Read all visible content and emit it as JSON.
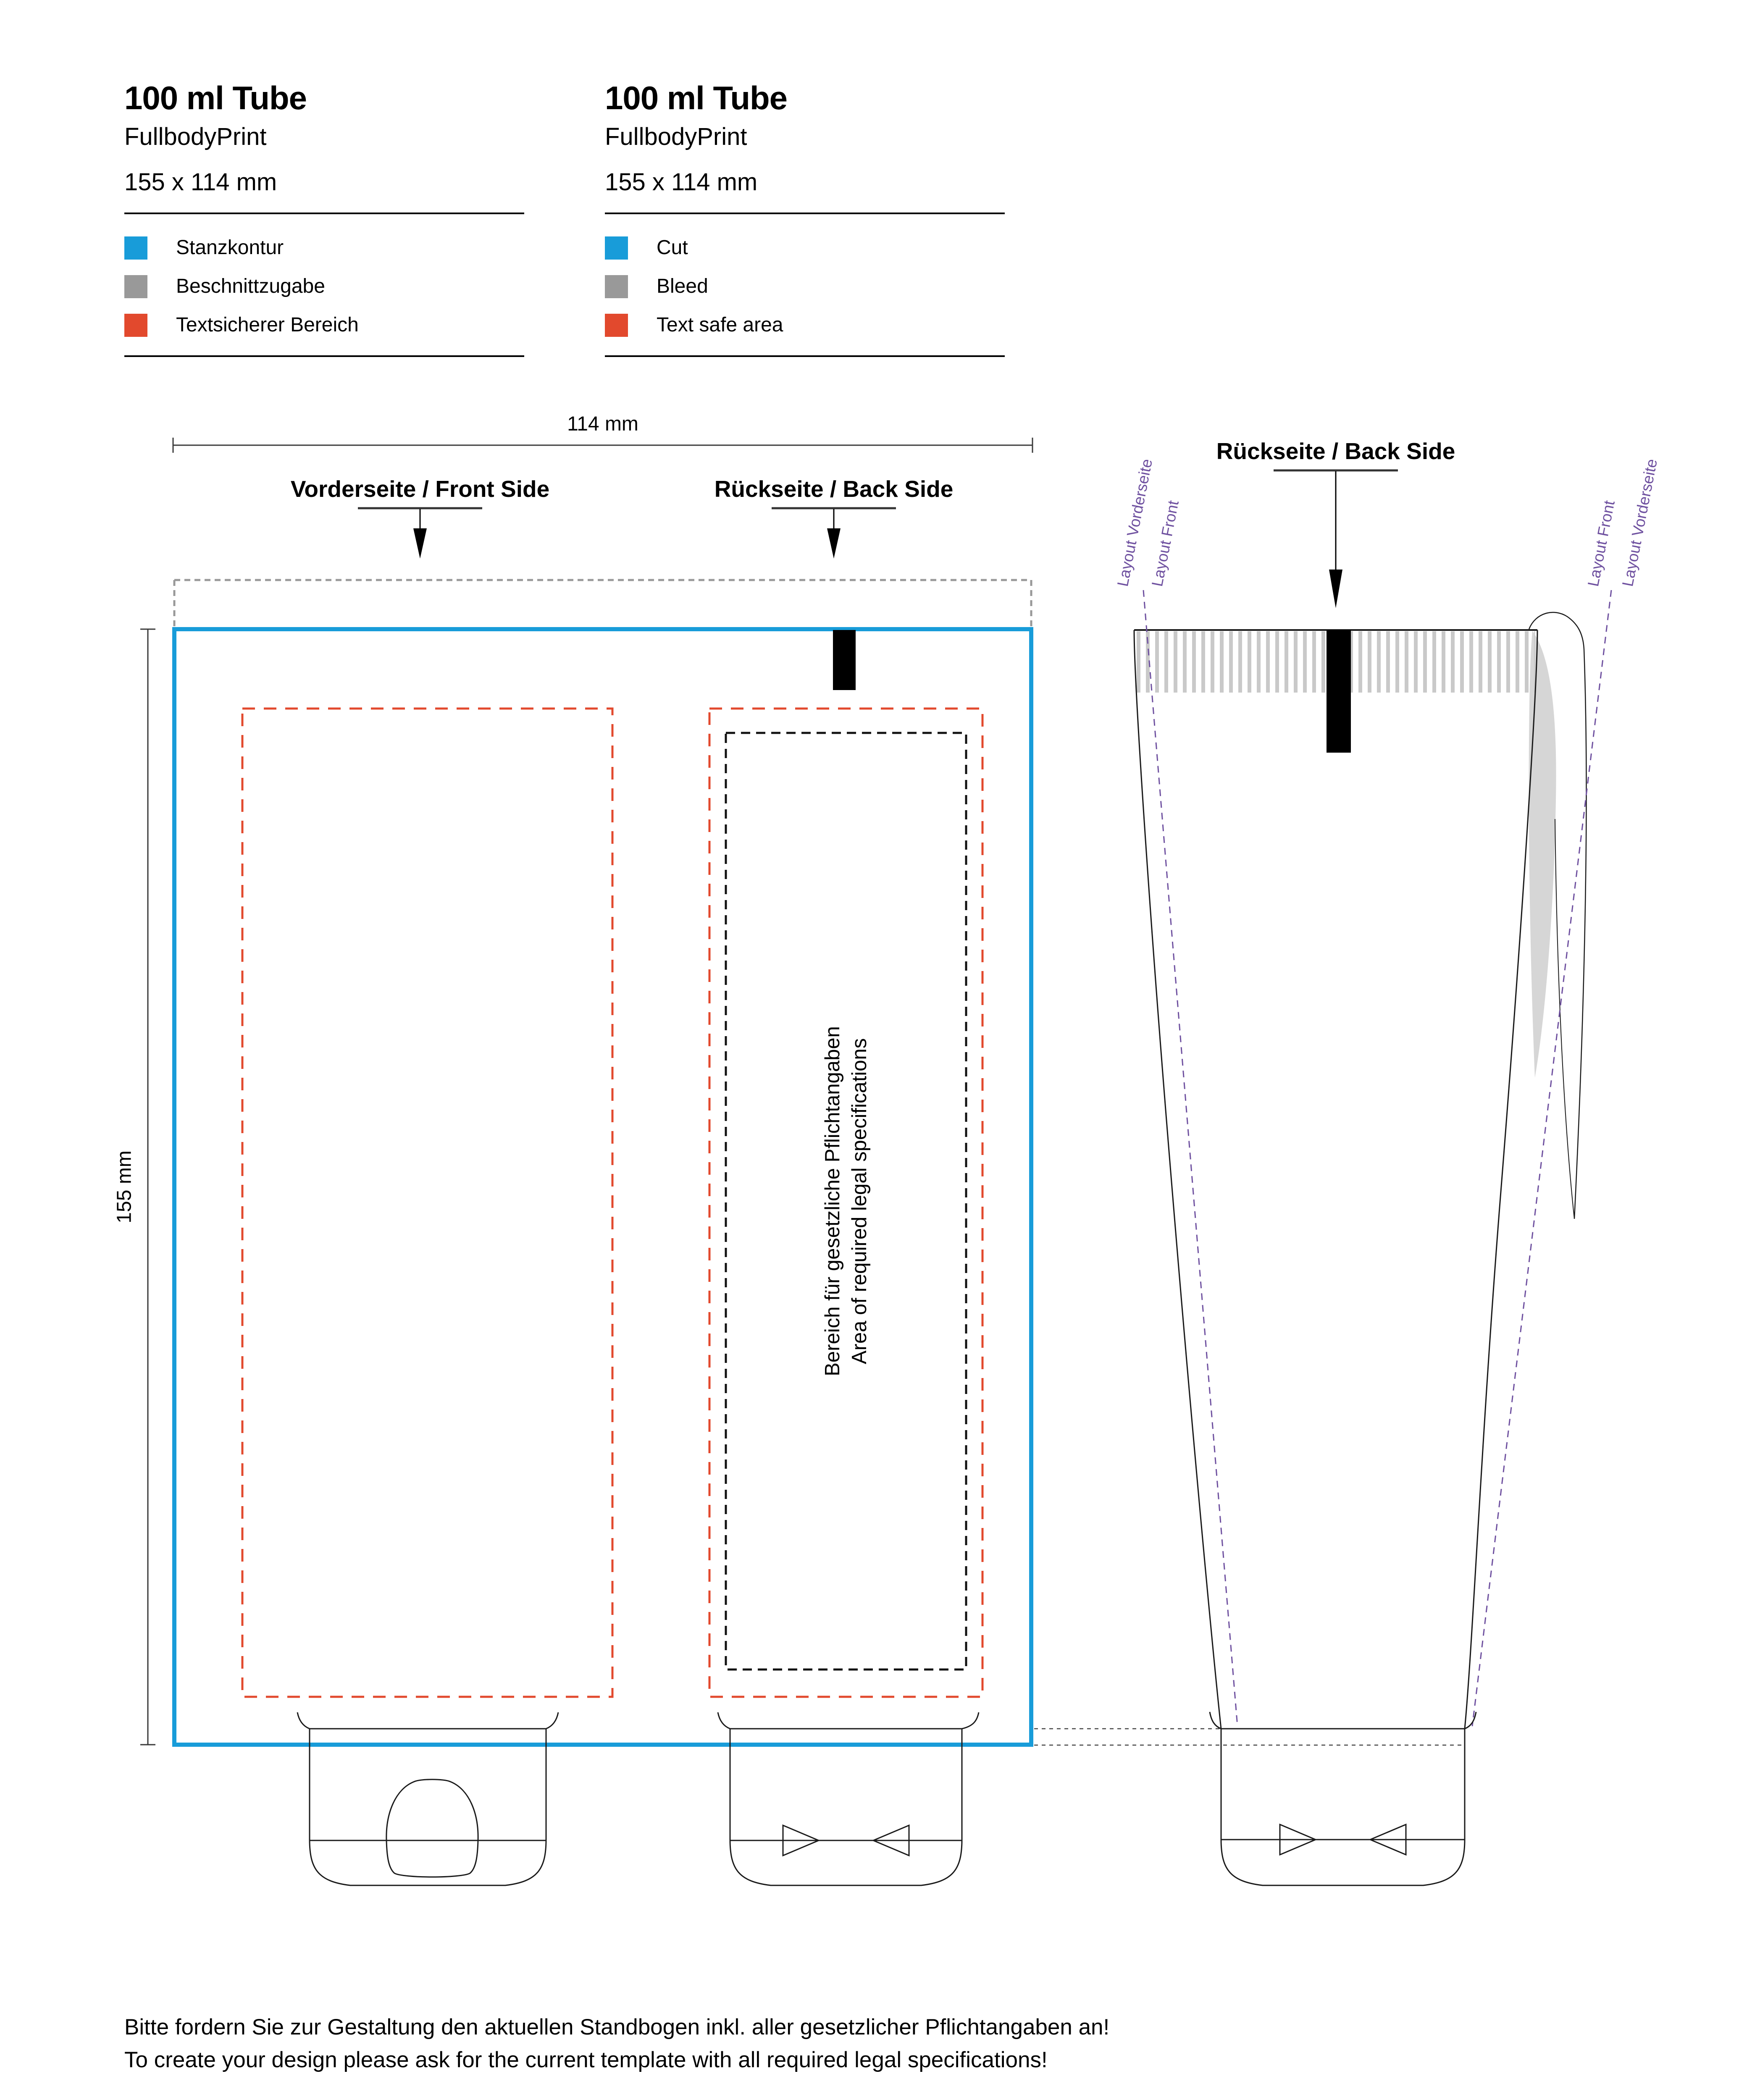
{
  "colors": {
    "cut": "#189CD9",
    "bleed": "#999999",
    "safe_area": "#E2492D",
    "layout_purple": "#6F51A0",
    "line_dark": "#1a1a1a",
    "hatch_gray": "#C9C9C9"
  },
  "headers": [
    {
      "title": "100 ml Tube",
      "subtitle": "FullbodyPrint",
      "size": "155 x 114 mm",
      "legend": [
        "Stanzkontur",
        "Beschnittzugabe",
        "Textsicherer Bereich"
      ]
    },
    {
      "title": "100 ml Tube",
      "subtitle": "FullbodyPrint",
      "size": "155 x 114 mm",
      "legend": [
        "Cut",
        "Bleed",
        "Text safe area"
      ]
    }
  ],
  "dieline": {
    "width_label": "114 mm",
    "height_label": "155 mm",
    "front_label": "Vorderseite / Front Side",
    "back_label": "Rückseite / Back Side",
    "legal_de": "Bereich für gesetzliche Pflichtangaben",
    "legal_en": "Area of required legal specifications"
  },
  "tube": {
    "title": "Rückseite / Back Side",
    "layout_labels": [
      "Layout Vorderseite",
      "Layout Front",
      "Layout Front",
      "Layout Vorderseite"
    ]
  },
  "footer": {
    "line1": "Bitte fordern Sie zur Gestaltung den aktuellen Standbogen inkl. aller gesetzlicher Pflichtangaben an!",
    "line2": "To create your design please ask for the current template with all required legal specifications!"
  }
}
